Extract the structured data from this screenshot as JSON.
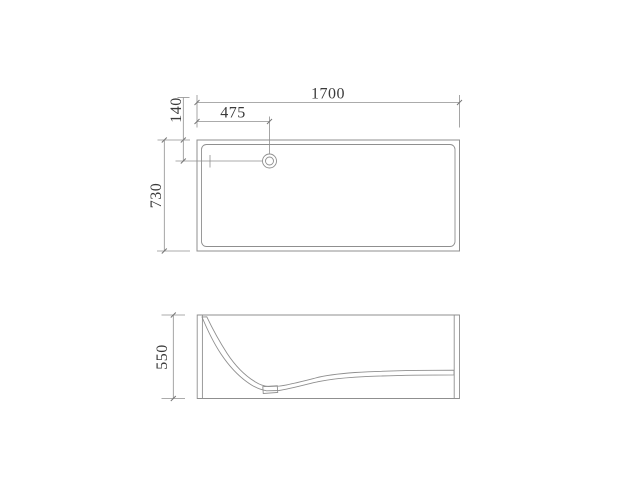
{
  "colors": {
    "background": "#ffffff",
    "line": "#8f8f8f",
    "line-dark": "#777777",
    "hatch": "#a0a0a0",
    "text": "#3a3a3a"
  },
  "views": {
    "top": {
      "length": "1700",
      "drain_offset": "475",
      "drain_depth": "140",
      "width": "730"
    },
    "side": {
      "height": "550"
    }
  }
}
